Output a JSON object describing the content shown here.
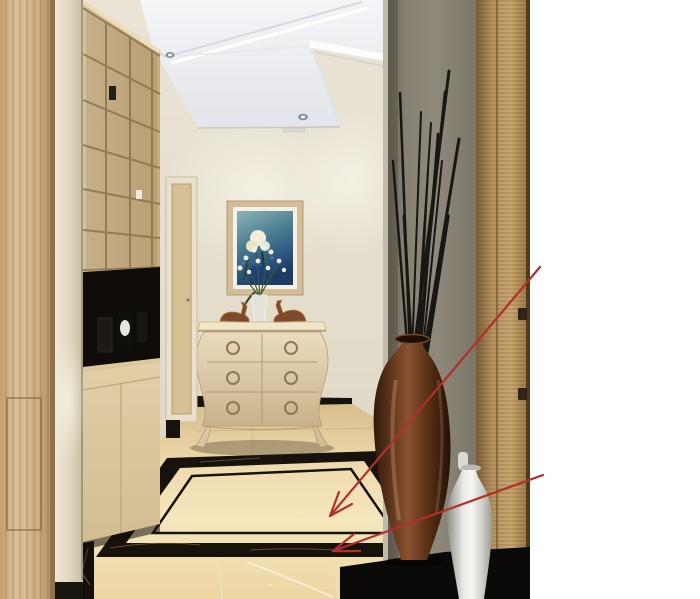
{
  "panel": {
    "background": "#ffffff",
    "products": [
      {
        "code": "KJP1809",
        "swatch": "beige-marble-tile",
        "base_color": "#f3d8a9",
        "border_color": "#8d4a3a"
      },
      {
        "code": "KYB8017",
        "swatch": "black-gold-marble-tile",
        "base_color": "#0a0806",
        "border_color": "#6b2f25"
      }
    ]
  },
  "annotation": {
    "line_color": "#b0302a"
  }
}
